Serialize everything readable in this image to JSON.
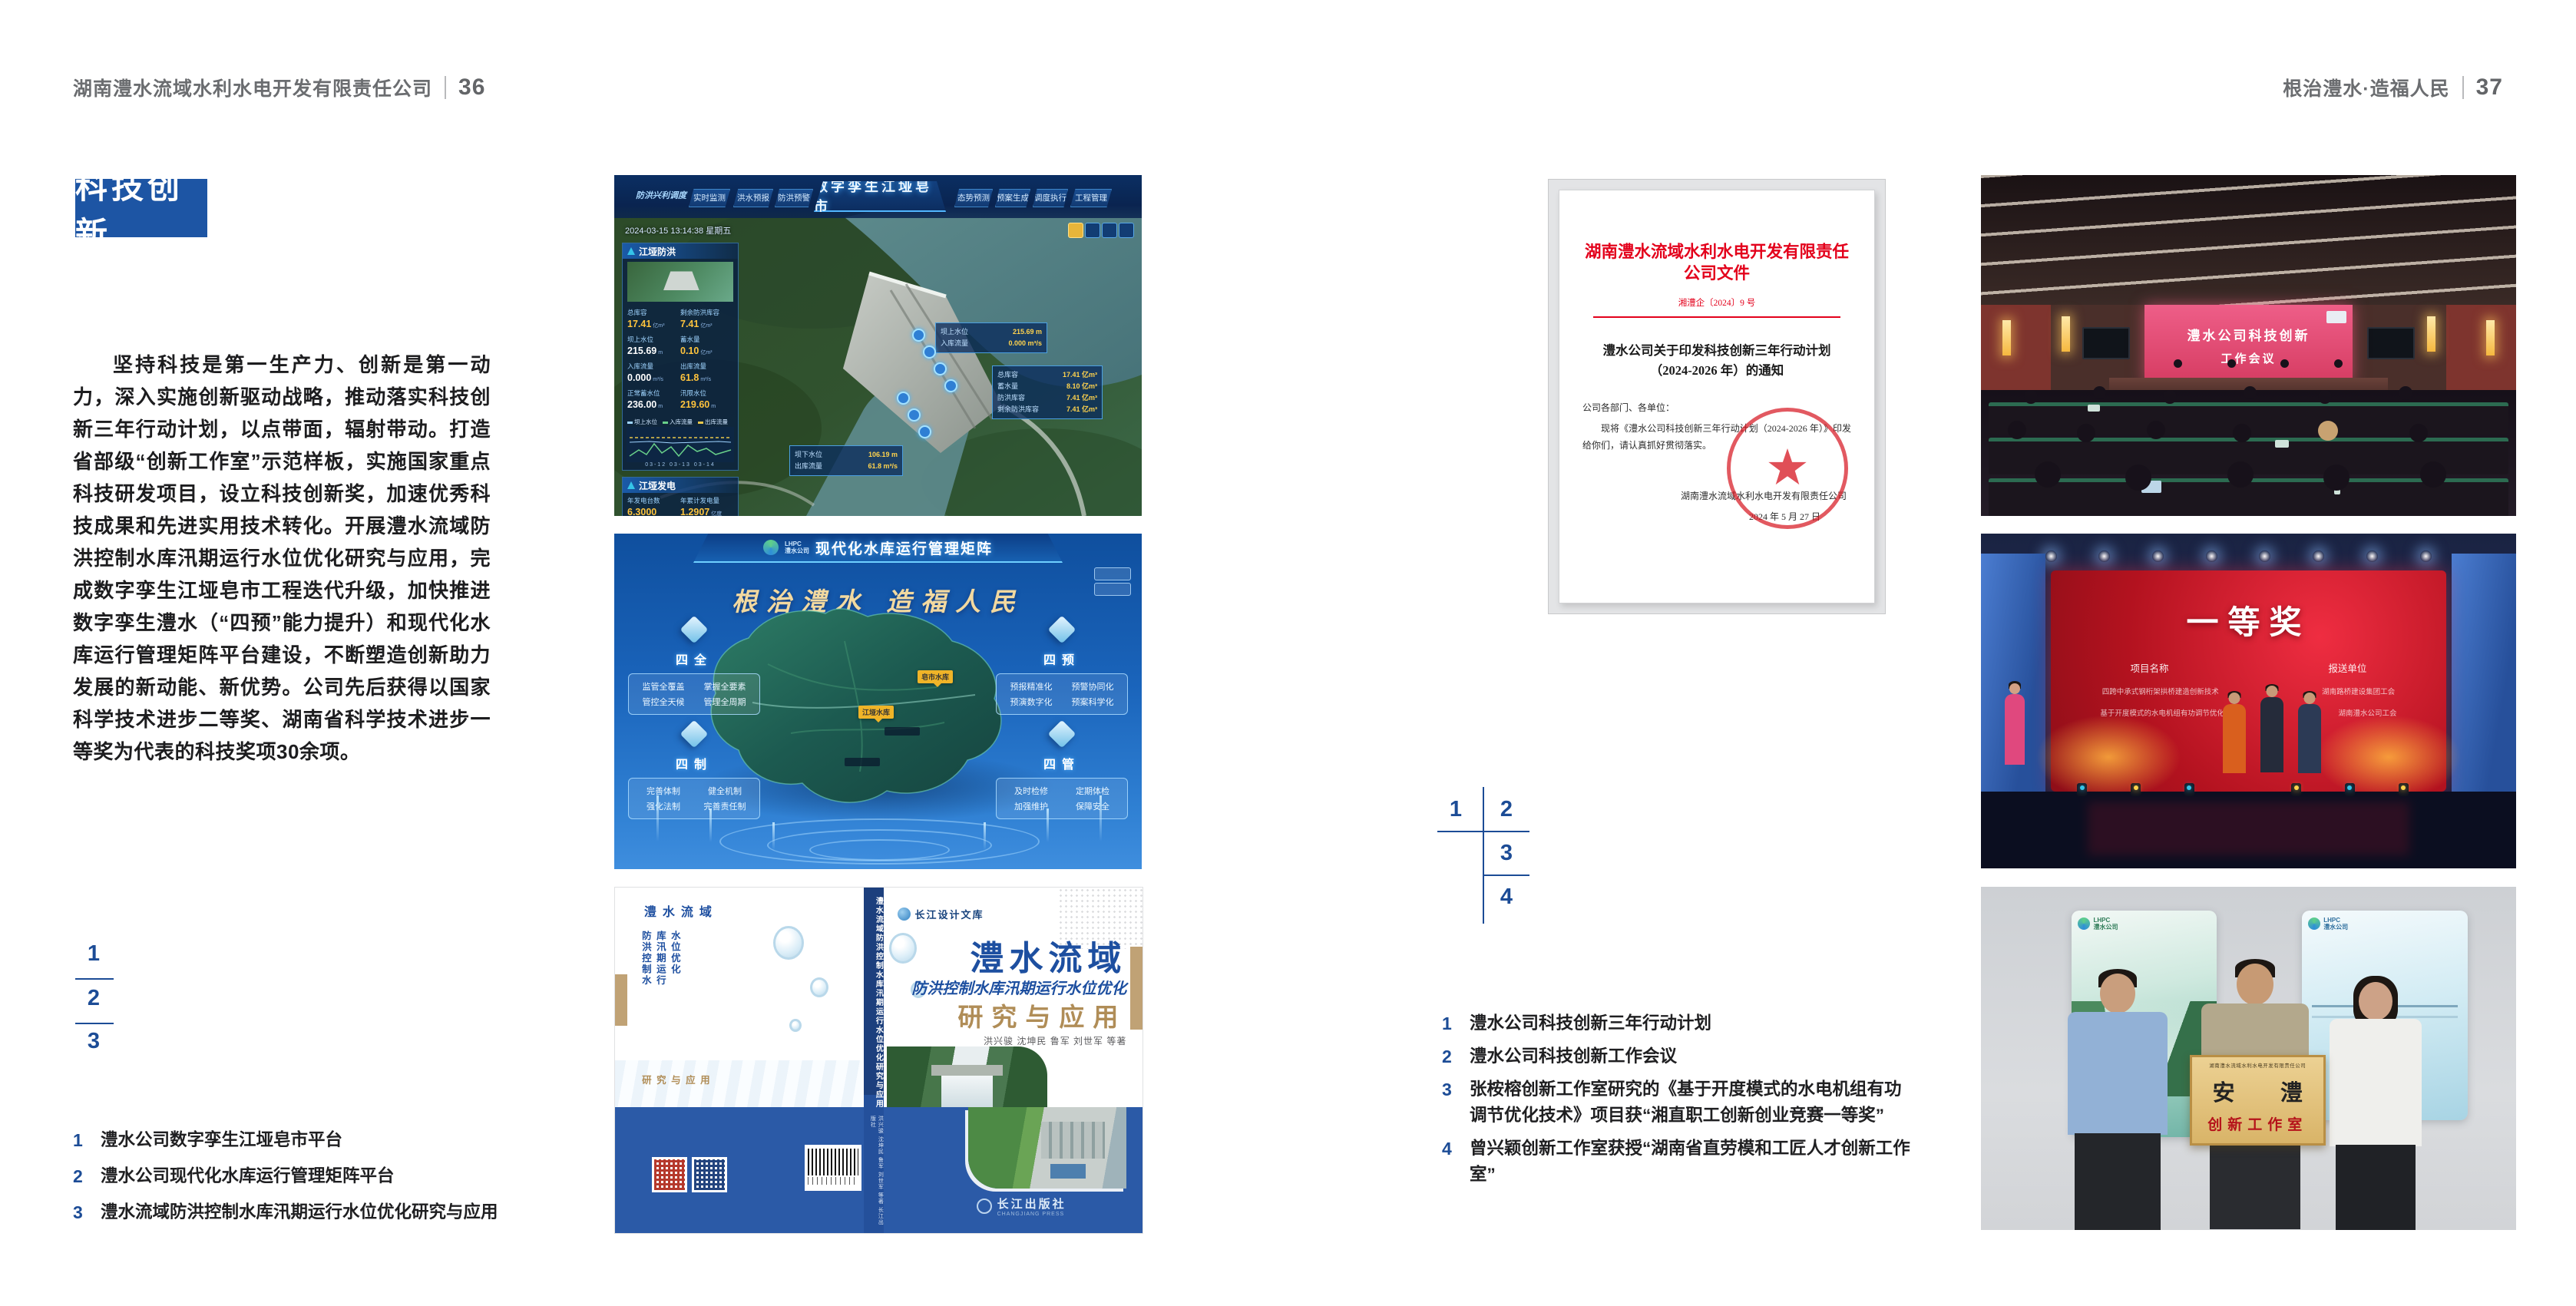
{
  "page_left": {
    "header_company": "湖南澧水流域水利水电开发有限责任公司",
    "header_page": "36",
    "section_title": "科技创新",
    "paragraph": "坚持科技是第一生产力、创新是第一动力，深入实施创新驱动战略，推动落实科技创新三年行动计划，以点带面，辐射带动。打造省部级“创新工作室”示范样板，实施国家重点科技研发项目，设立科技创新奖，加速优秀科技成果和先进实用技术转化。开展澧水流域防洪控制水库汛期运行水位优化研究与应用，完成数字孪生江垭皂市工程迭代升级，加快推进数字孪生澧水（“四预”能力提升）和现代化水库运行管理矩阵平台建设，不断塑造创新助力发展的新动能、新优势。公司先后获得以国家科学技术进步二等奖、湖南省科学技术进步一等奖为代表的科技奖项30余项。",
    "fig_index": [
      "1",
      "2",
      "3"
    ],
    "captions": [
      {
        "num": "1",
        "text": "澧水公司数字孪生江垭皂市平台"
      },
      {
        "num": "2",
        "text": "澧水公司现代化水库运行管理矩阵平台"
      },
      {
        "num": "3",
        "text": "澧水流域防洪控制水库汛期运行水位优化研究与应用"
      }
    ]
  },
  "dashboard": {
    "title": "数字孪生江垭皂市",
    "menu_label": "防洪兴利调度",
    "nav_left": [
      "实时监测",
      "洪水预报",
      "防洪预警"
    ],
    "nav_right": [
      "态势预测",
      "预案生成",
      "调度执行",
      "工程管理"
    ],
    "timestamp": "2024-03-15 13:14:38 星期五",
    "panel_flood_title": "江垭防洪",
    "panel_power_title": "江垭发电",
    "flood_stats": [
      {
        "label": "总库容",
        "value": "17.41",
        "unit": "亿m³"
      },
      {
        "label": "剩余防洪库容",
        "value": "7.41",
        "unit": "亿m³"
      },
      {
        "label": "坝上水位",
        "value": "215.69",
        "unit": "m"
      },
      {
        "label": "蓄水量",
        "value": "0.10",
        "unit": "亿m³"
      },
      {
        "label": "入库流量",
        "value": "0.000",
        "unit": "m³/s"
      },
      {
        "label": "出库流量",
        "value": "61.8",
        "unit": "m³/s"
      },
      {
        "label": "正常蓄水位",
        "value": "236.00",
        "unit": "m"
      },
      {
        "label": "汛限水位",
        "value": "219.60",
        "unit": "m"
      }
    ],
    "legend": [
      "坝上水位",
      "入库流量",
      "出库流量"
    ],
    "chart_dates": "03-12  03-13  03-14",
    "power_stats": [
      {
        "label": "年发电台数",
        "value": "6.3000",
        "unit": ""
      },
      {
        "label": "年累计发电量",
        "value": "1.2907",
        "unit": "亿度"
      },
      {
        "label": "月累计发电量",
        "value": "3359.21",
        "unit": "万度"
      },
      {
        "label": "当前出力",
        "value": "0.00",
        "unit": "MW"
      },
      {
        "label": "发电流量",
        "value": "0.00",
        "unit": "m³/s"
      },
      {
        "label": "弃水流量",
        "value": "0.00",
        "unit": "m³/s"
      }
    ],
    "callout_up": {
      "l1": "坝上水位",
      "v1": "215.69 m",
      "l2": "入库流量",
      "v2": "0.000 m³/s"
    },
    "side_panel": [
      {
        "label": "总库容",
        "value": "17.41 亿m³"
      },
      {
        "label": "蓄水量",
        "value": "8.10 亿m³"
      },
      {
        "label": "防洪库容",
        "value": "7.41 亿m³"
      },
      {
        "label": "剩余防洪库容",
        "value": "7.41 亿m³"
      }
    ],
    "callout_down": {
      "l1": "坝下水位",
      "v1": "106.19 m",
      "l2": "出库流量",
      "v2": "61.8 m³/s"
    }
  },
  "matrix": {
    "logo_line1": "LHPC",
    "logo_line2": "澧水公司",
    "title": "现代化水库运行管理矩阵",
    "slogan": "根治澧水 造福人民",
    "panels": [
      {
        "title": "四全",
        "items": [
          "监管全覆盖",
          "掌握全要素",
          "管控全天候",
          "管理全周期"
        ]
      },
      {
        "title": "四预",
        "items": [
          "预报精准化",
          "预警协同化",
          "预演数字化",
          "预案科学化"
        ]
      },
      {
        "title": "四制",
        "items": [
          "完善体制",
          "健全机制",
          "强化法制",
          "完善责任制"
        ]
      },
      {
        "title": "四管",
        "items": [
          "及时检修",
          "定期体检",
          "加强维护",
          "保障安全"
        ]
      }
    ],
    "markers": [
      "皂市水库",
      "江垭水库"
    ]
  },
  "book": {
    "brand": "长江设计文库",
    "title_main": "澧水流域",
    "title_sub": "防洪控制水库汛期运行水位优化",
    "title_tail": "研究与应用",
    "authors": "洪兴骏  沈坤民  鲁军  刘世军  等著",
    "spine": "澧水流域防洪控制水库汛期运行水位优化研究与应用",
    "spine_authors": "洪兴骏 沈坤民 鲁军 刘世军 等著  长江出版社",
    "back_col1": "澧水流域",
    "back_col2": "防洪控制水库汛期运行水位优化",
    "back_col3": "研究与应用",
    "publisher": "长江出版社",
    "publisher_en": "CHANGJIANG PRESS"
  },
  "page_right": {
    "header_slogan": "根治澧水·造福人民",
    "header_page": "37",
    "fig_index": [
      "1",
      "2",
      "3",
      "4"
    ],
    "captions": [
      {
        "num": "1",
        "text": "澧水公司科技创新三年行动计划"
      },
      {
        "num": "2",
        "text": "澧水公司科技创新工作会议"
      },
      {
        "num": "3",
        "text": "张桉榕创新工作室研究的《基于开度模式的水电机组有功调节优化技术》项目获“湘直职工创新创业竞赛一等奖”"
      },
      {
        "num": "4",
        "text": "曾兴颖创新工作室获授“湖南省直劳模和工匠人才创新工作室”"
      }
    ]
  },
  "document": {
    "title": "湖南澧水流域水利水电开发有限责任公司文件",
    "doc_no": "湘澧企〔2024〕9 号",
    "subject1": "澧水公司关于印发科技创新三年行动计划",
    "subject2": "（2024-2026 年）的通知",
    "salutation": "公司各部门、各单位：",
    "body": "现将《澧水公司科技创新三年行动计划（2024-2026 年）》印发给你们，请认真抓好贯彻落实。",
    "signer": "湖南澧水流域水利水电开发有限责任公司",
    "date": "2024 年 5 月 27 日"
  },
  "photos": {
    "meeting": {
      "screen1": "澧水公司科技创新",
      "screen2": "工作会议"
    },
    "award": {
      "title": "一等奖",
      "col1": "项目名称",
      "col2": "报送单位",
      "row1a": "四跨中承式钢桁架拱桥建造创新技术",
      "row1b": "湖南路桥建设集团工会",
      "row2a": "基于开度模式的水电机组有功调节优化技术",
      "row2b": "湖南澧水公司工会"
    },
    "plaque": {
      "header": "湖南澧水流域水利水电开发有限责任公司",
      "line1": "安 澧",
      "line2": "创新工作室",
      "poster_logo1": "LHPC",
      "poster_logo2": "澧水公司"
    }
  },
  "colors": {
    "accent_blue": "#1d55a4",
    "caption_blue": "#1c4c96",
    "doc_red": "#e3001b",
    "book_blue": "#2b5aa7",
    "gold": "#c0a275"
  }
}
